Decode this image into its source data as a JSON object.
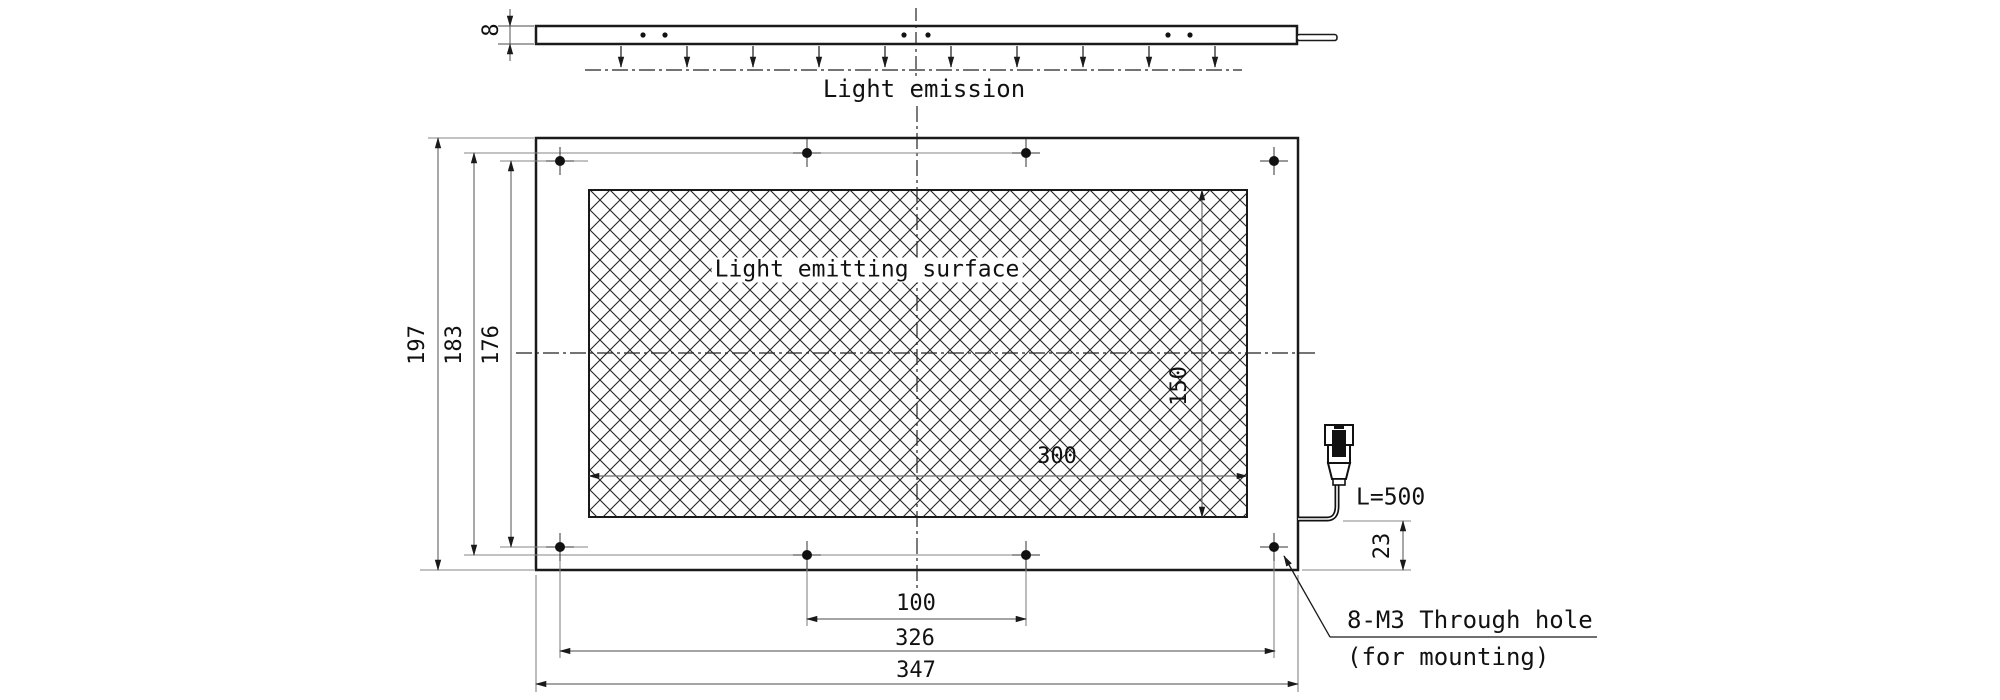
{
  "colors": {
    "object_line": "#1a1a1a",
    "dimension_line": "#6e6e6e",
    "centerline": "#222222",
    "background": "#ffffff"
  },
  "side_view": {
    "thickness": "8",
    "emission_label": "Light emission"
  },
  "front_view": {
    "surface_label": "Light emitting surface",
    "dim_surface_width": "300",
    "dim_surface_height": "150",
    "dim_outer_height": "197",
    "dim_mid_hole_rows": "183",
    "dim_corner_hole_rows": "176",
    "dim_mid_hole_cols": "100",
    "dim_corner_hole_cols": "326",
    "dim_outer_width": "347",
    "dim_cable_offset": "23",
    "cable_length": "L=500",
    "callout_line1": "8-M3 Through hole",
    "callout_line2": "(for mounting)"
  }
}
